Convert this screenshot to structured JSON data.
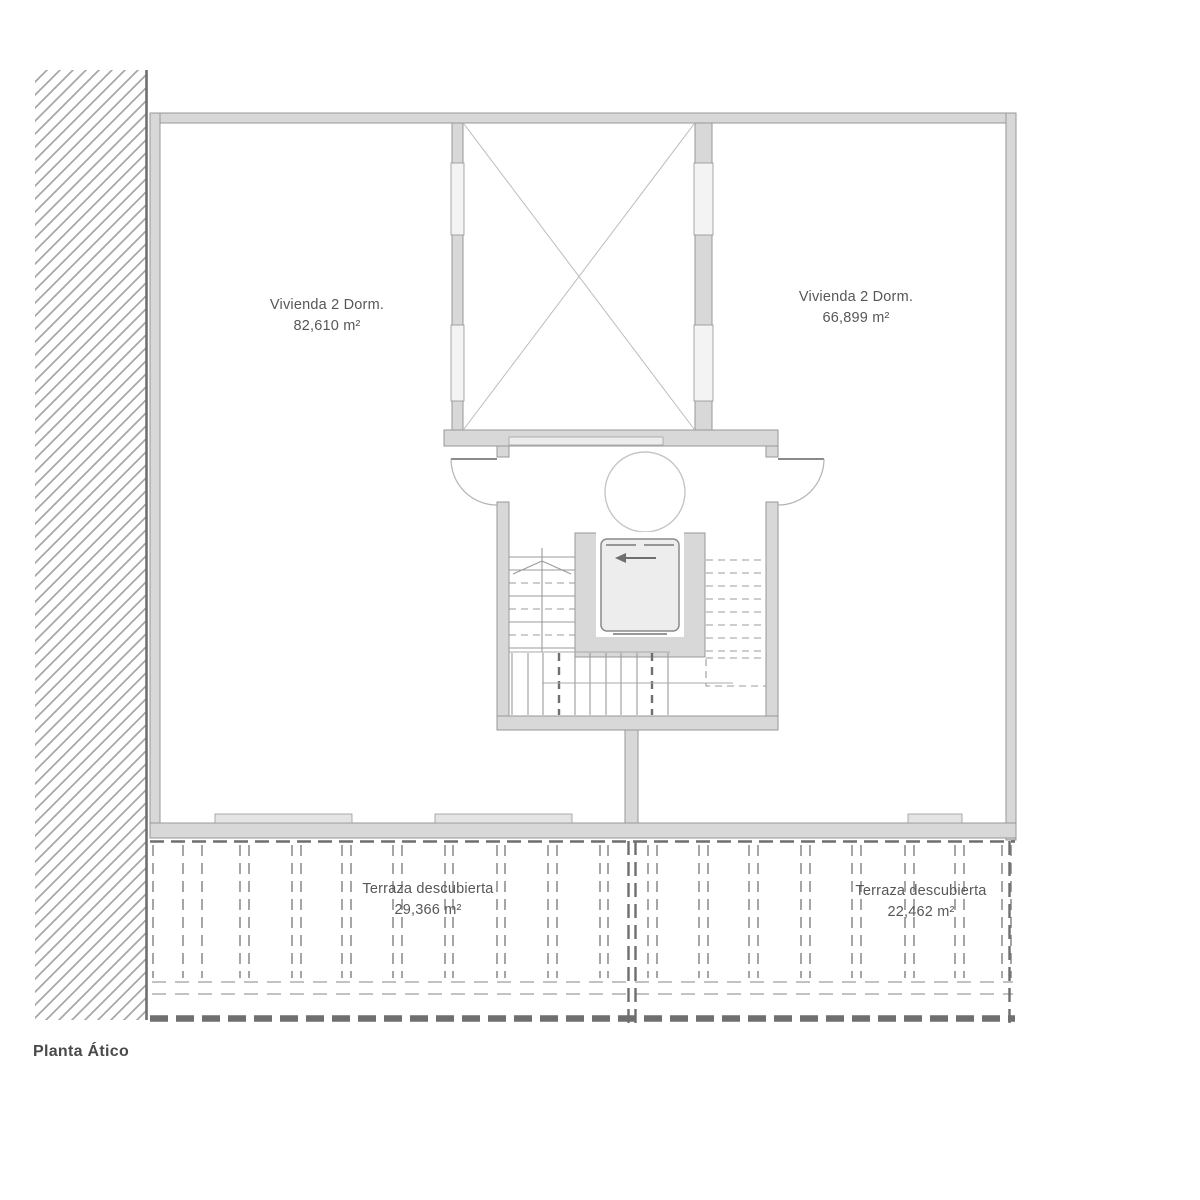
{
  "title": "Planta Ático",
  "rooms": {
    "vivienda_left": {
      "name": "Vivienda 2 Dorm.",
      "area": "82,610 m²"
    },
    "vivienda_right": {
      "name": "Vivienda 2 Dorm.",
      "area": "66,899 m²"
    },
    "terraza_left": {
      "name": "Terraza descubierta",
      "area": "29,366 m²"
    },
    "terraza_right": {
      "name": "Terraza descubierta",
      "area": "22,462 m²"
    }
  },
  "icons": {
    "elevator_direction": "left-arrow"
  },
  "colors": {
    "background": "#ffffff",
    "wall_fill": "#d8d8d8",
    "wall_stroke": "#979797",
    "hatch_line": "#a6a6a6",
    "dashed_dark": "#6e6e6e",
    "text": "#575757"
  }
}
